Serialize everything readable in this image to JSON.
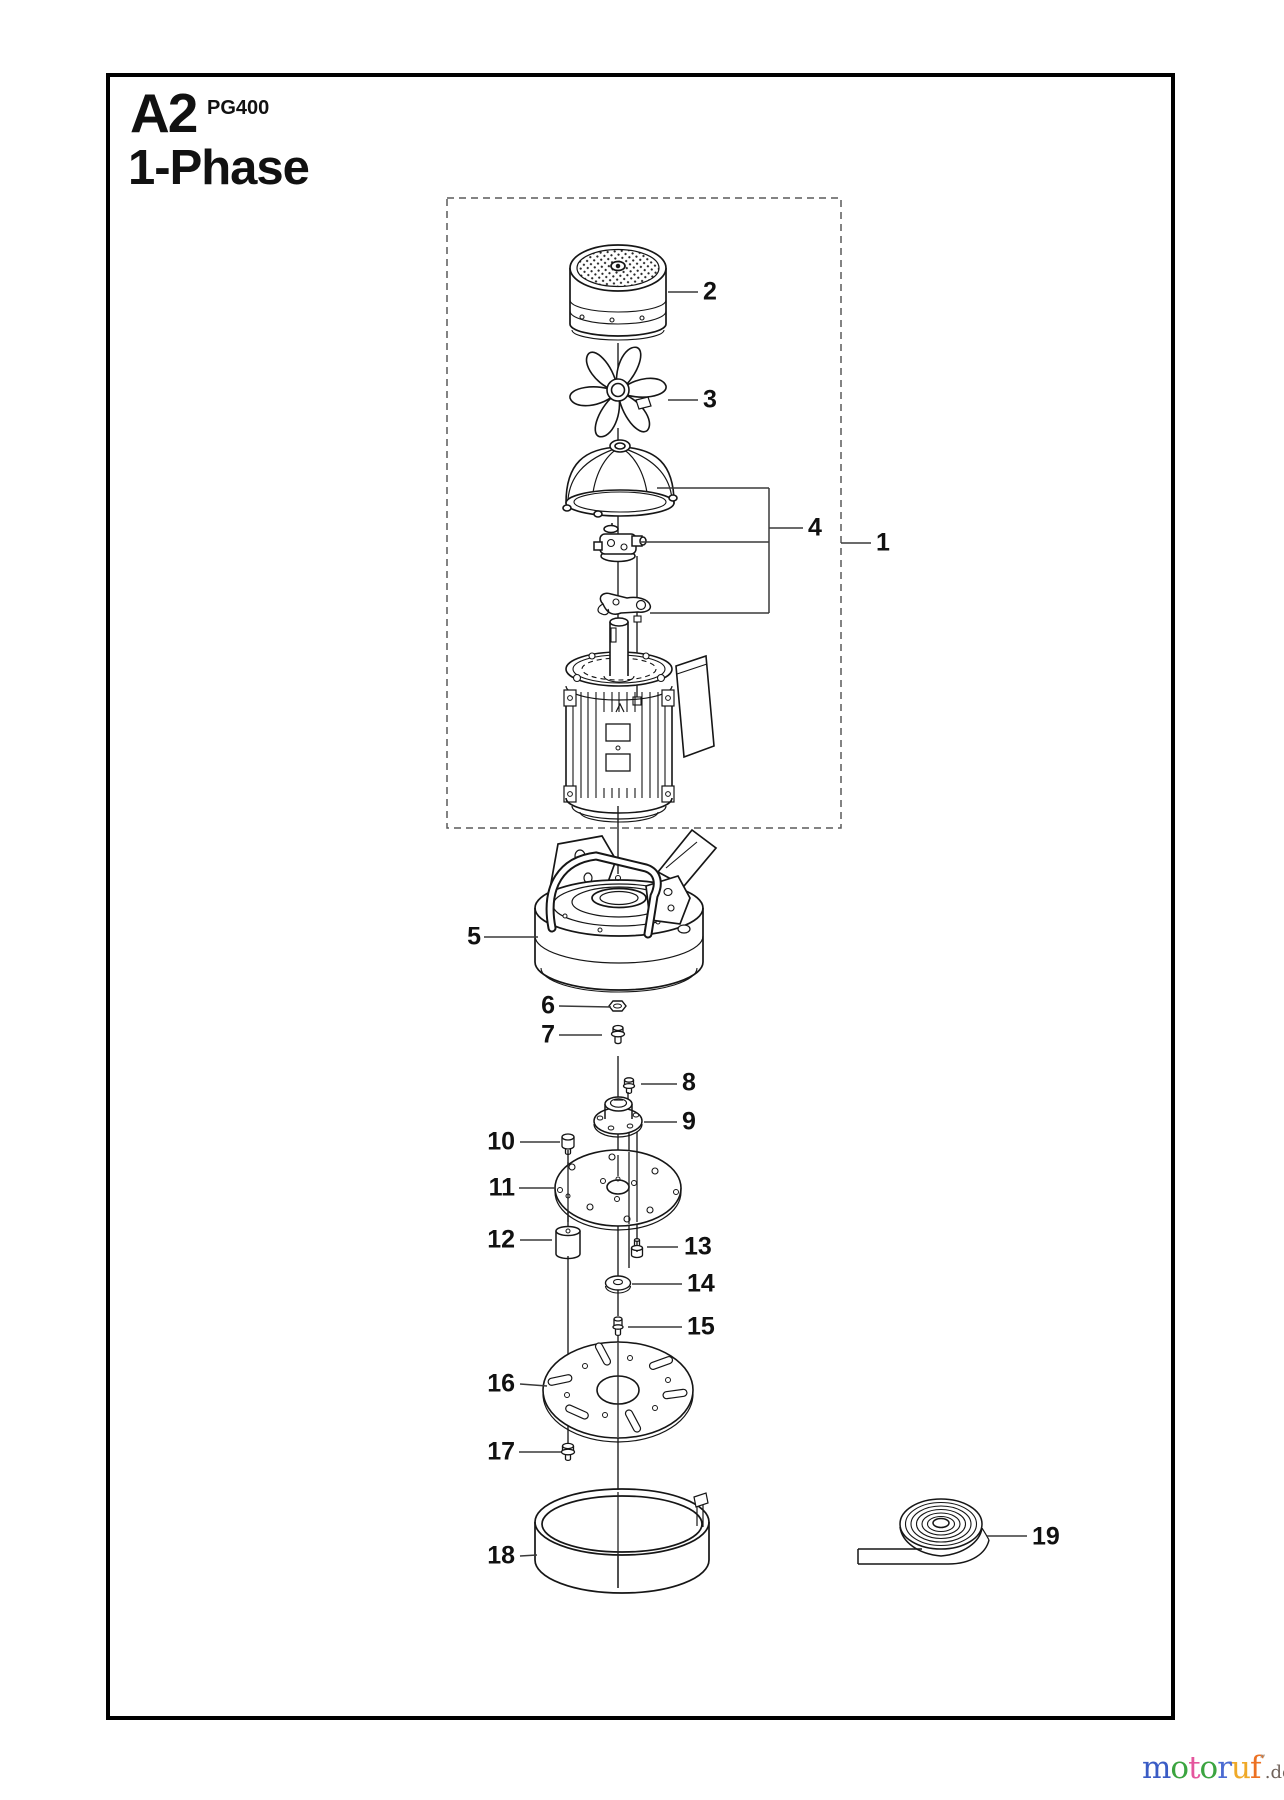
{
  "header": {
    "sheet_code": "A2",
    "model": "PG400",
    "variant": "1-Phase"
  },
  "parts": [
    "1",
    "2",
    "3",
    "4",
    "5",
    "6",
    "7",
    "8",
    "9",
    "10",
    "11",
    "12",
    "13",
    "14",
    "15",
    "16",
    "17",
    "18",
    "19"
  ],
  "watermark": {
    "letters": [
      {
        "char": "m",
        "color": "#3a5cc5"
      },
      {
        "char": "o",
        "color": "#3ba440"
      },
      {
        "char": "t",
        "color": "#e4569d"
      },
      {
        "char": "o",
        "color": "#3ba440"
      },
      {
        "char": "r",
        "color": "#4b6bd2"
      },
      {
        "char": "u",
        "color": "#efa928"
      },
      {
        "char": "f",
        "color": "#ec7123"
      }
    ],
    "tick": "’’",
    "suffix": ".de",
    "suffix_color": "#70635b"
  },
  "diagram": {
    "line_color": "#161616",
    "leader_color": "#3a3a3a",
    "dash_color": "#5a5a5a",
    "background": "#ffffff"
  }
}
